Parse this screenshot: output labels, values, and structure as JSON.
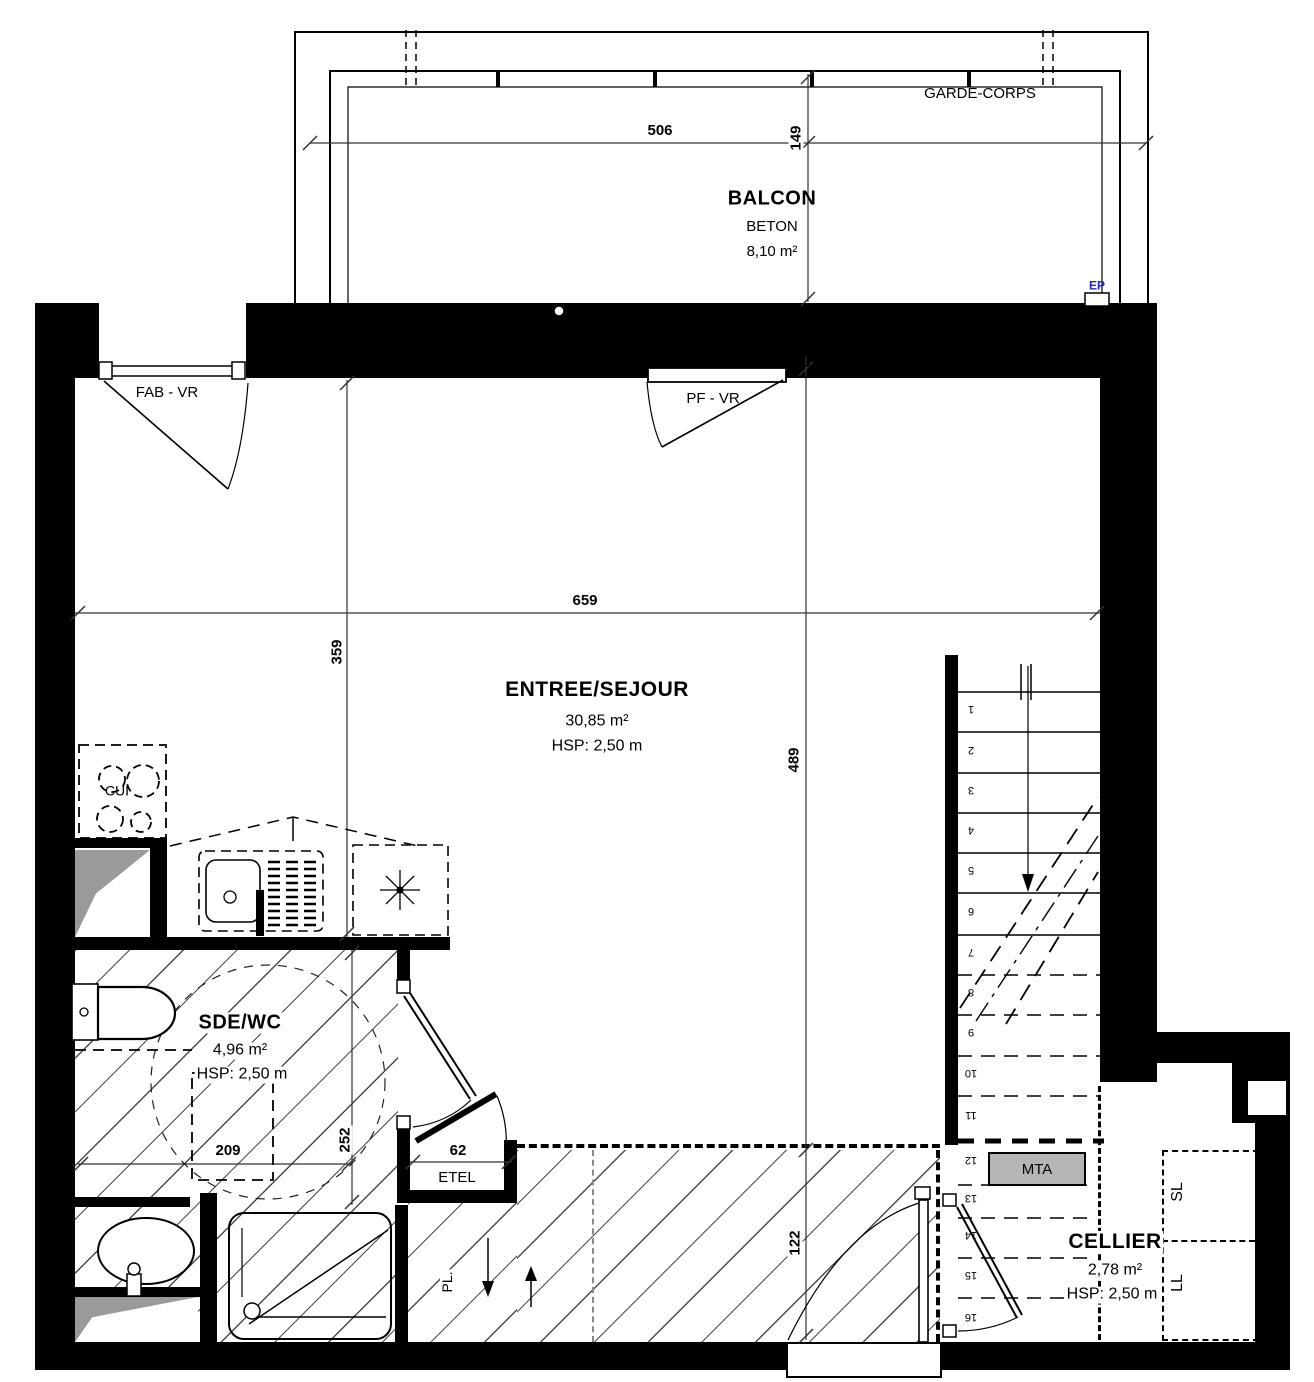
{
  "balcony": {
    "name": "BALCON",
    "material": "BETON",
    "area": "8,10 m²",
    "guardrail_label": "GARDE-CORPS",
    "ep_label": "EP",
    "width_dim": "506",
    "depth_dim": "149"
  },
  "living_room": {
    "name": "ENTREE/SEJOUR",
    "area": "30,85 m²",
    "ceiling": "HSP: 2,50 m",
    "width_dim": "659",
    "left_depth_dim": "359",
    "right_depth_dim": "489",
    "entry_depth_dim": "122"
  },
  "openings": {
    "window_left": "FAB - VR",
    "window_center": "PF - VR"
  },
  "kitchen": {
    "name": "CUI"
  },
  "bathroom": {
    "name": "SDE/WC",
    "area": "4,96 m²",
    "ceiling": "HSP: 2,50 m",
    "width_dim": "209",
    "depth_dim": "252"
  },
  "closet": {
    "name": "ETEL",
    "width_dim": "62"
  },
  "duct": {
    "name": "PL."
  },
  "stairs": {
    "landing_label": "MTA",
    "steps": [
      "1",
      "2",
      "3",
      "4",
      "5",
      "6",
      "7",
      "8",
      "9",
      "10",
      "11",
      "12",
      "13",
      "14",
      "15",
      "16"
    ]
  },
  "cellier": {
    "name": "CELLIER",
    "area": "2,78 m²",
    "ceiling": "HSP: 2,50 m",
    "dryer_label": "SL",
    "washer_label": "LL"
  },
  "colors": {
    "wall": "#000000",
    "ep_blue": "#2323cf",
    "mta_gray": "#b5b5b5"
  }
}
